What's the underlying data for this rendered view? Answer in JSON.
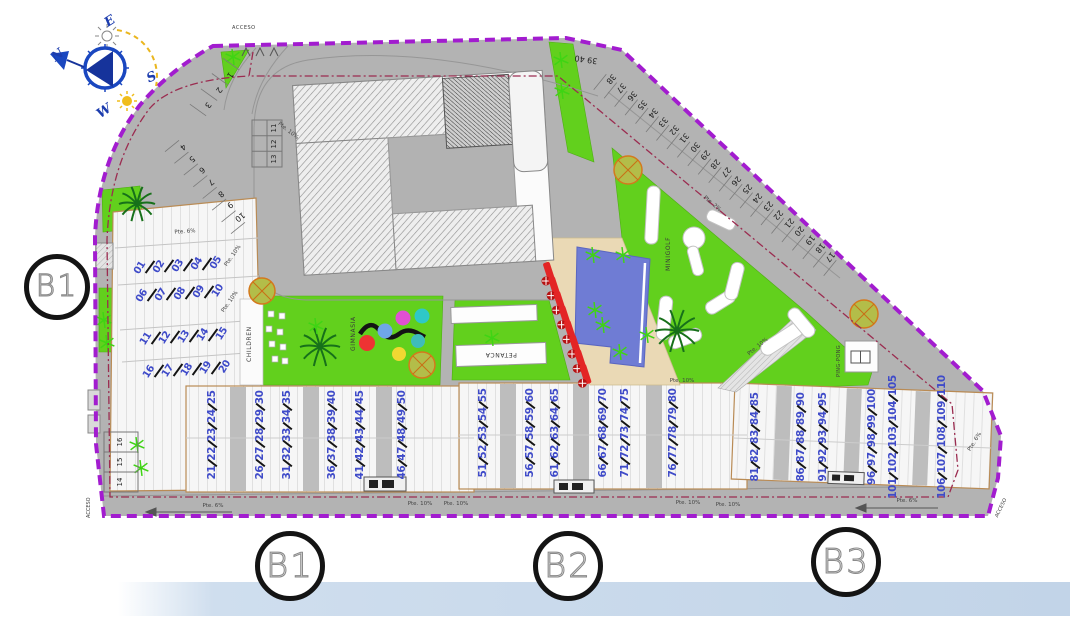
{
  "compass": {
    "n": "N",
    "e": "E",
    "s": "S",
    "w": "W"
  },
  "access": {
    "top": "ACCESO",
    "bottom_left": "ACCESO",
    "bottom_right": "ACCESO"
  },
  "amenities": {
    "children": "CHILDREN",
    "gym": "GIMNASIA",
    "petanca": "PETANCA",
    "minigolf": "MINIGOLF",
    "pingpong": "PING-PONG"
  },
  "section_markers": {
    "left": "B1",
    "bottom": [
      "B1",
      "B2",
      "B3"
    ]
  },
  "parking": {
    "upper_left": [
      "1",
      "2",
      "3"
    ],
    "left_ramp": [
      "4",
      "5",
      "6",
      "7",
      "8",
      "9",
      "10"
    ],
    "box": [
      "11",
      "12",
      "13"
    ],
    "lower_left": [
      "16",
      "15",
      "14"
    ],
    "diagonal": [
      "17",
      "18",
      "19",
      "20",
      "21",
      "22",
      "23",
      "24",
      "25",
      "26",
      "27",
      "28",
      "29",
      "30",
      "31",
      "32",
      "33",
      "34",
      "35",
      "36",
      "37",
      "38"
    ],
    "top_pair": "39 40"
  },
  "units": {
    "rows": [
      [
        "01",
        "02",
        "03",
        "04",
        "05"
      ],
      [
        "06",
        "07",
        "08",
        "09",
        "10"
      ],
      [
        "11",
        "12",
        "13",
        "14",
        "15"
      ],
      [
        "16",
        "17",
        "18",
        "19",
        "20"
      ]
    ]
  },
  "townhouses": {
    "rows": [
      [
        [
          "21",
          "22",
          "23",
          "24",
          "25"
        ],
        [
          "26",
          "27",
          "28",
          "29",
          "30"
        ],
        [
          "31",
          "32",
          "33",
          "34",
          "35"
        ],
        [
          "36",
          "37",
          "38",
          "39",
          "40"
        ],
        [
          "41",
          "42",
          "43",
          "44",
          "45"
        ],
        [
          "46",
          "47",
          "48",
          "49",
          "50"
        ]
      ],
      [
        [
          "51",
          "52",
          "53",
          "54",
          "55"
        ],
        [
          "56",
          "57",
          "58",
          "59",
          "60"
        ],
        [
          "61",
          "62",
          "63",
          "64",
          "65"
        ],
        [
          "66",
          "67",
          "68",
          "69",
          "70"
        ],
        [
          "71",
          "72",
          "73",
          "74",
          "75"
        ],
        [
          "76",
          "77",
          "78",
          "79",
          "80"
        ]
      ],
      [
        [
          "81",
          "82",
          "83",
          "84",
          "85"
        ],
        [
          "86",
          "87",
          "88",
          "89",
          "90"
        ],
        [
          "91",
          "92",
          "93",
          "94",
          "95"
        ],
        [
          "96",
          "97",
          "98",
          "99",
          "100"
        ],
        [
          "101",
          "102",
          "103",
          "104",
          "105"
        ],
        [
          "106",
          "107",
          "108",
          "109",
          "110"
        ]
      ]
    ]
  },
  "slopes": [
    {
      "text": "Pte. 10%",
      "x": 288,
      "y": 131,
      "r": 38
    },
    {
      "text": "Pte. 6%",
      "x": 185,
      "y": 232,
      "r": -4
    },
    {
      "text": "Pte. 10%",
      "x": 233,
      "y": 256,
      "r": -55
    },
    {
      "text": "Pte. 10%",
      "x": 230,
      "y": 302,
      "r": -55
    },
    {
      "text": "Pte. 2%",
      "x": 712,
      "y": 204,
      "r": 40
    },
    {
      "text": "Pte. 10%",
      "x": 758,
      "y": 347,
      "r": -40
    },
    {
      "text": "Pte. 10%",
      "x": 682,
      "y": 381,
      "r": 0
    },
    {
      "text": "Pte. 6%",
      "x": 213,
      "y": 506,
      "r": 0
    },
    {
      "text": "Pte. 10%",
      "x": 420,
      "y": 504,
      "r": 0
    },
    {
      "text": "Pte. 10%",
      "x": 456,
      "y": 504,
      "r": 0
    },
    {
      "text": "Pte. 10%",
      "x": 688,
      "y": 503,
      "r": 0
    },
    {
      "text": "Pte. 10%",
      "x": 728,
      "y": 505,
      "r": 0
    },
    {
      "text": "Pte. 6%",
      "x": 907,
      "y": 501,
      "r": 0
    },
    {
      "text": "Pte. 6%",
      "x": 975,
      "y": 442,
      "r": -58
    }
  ],
  "colors": {
    "boundary": "#a21ccf",
    "inner_boundary": "#9b2c50",
    "road": "#b3b3b3",
    "grass": "#62d01d",
    "pool": "#6f7cd4",
    "deck": "#ead9b5",
    "unit_number": "#3f4bc9",
    "lounger": "#e32525",
    "compass_blue": "#1c3cae",
    "sun_yellow": "#eab61e"
  }
}
